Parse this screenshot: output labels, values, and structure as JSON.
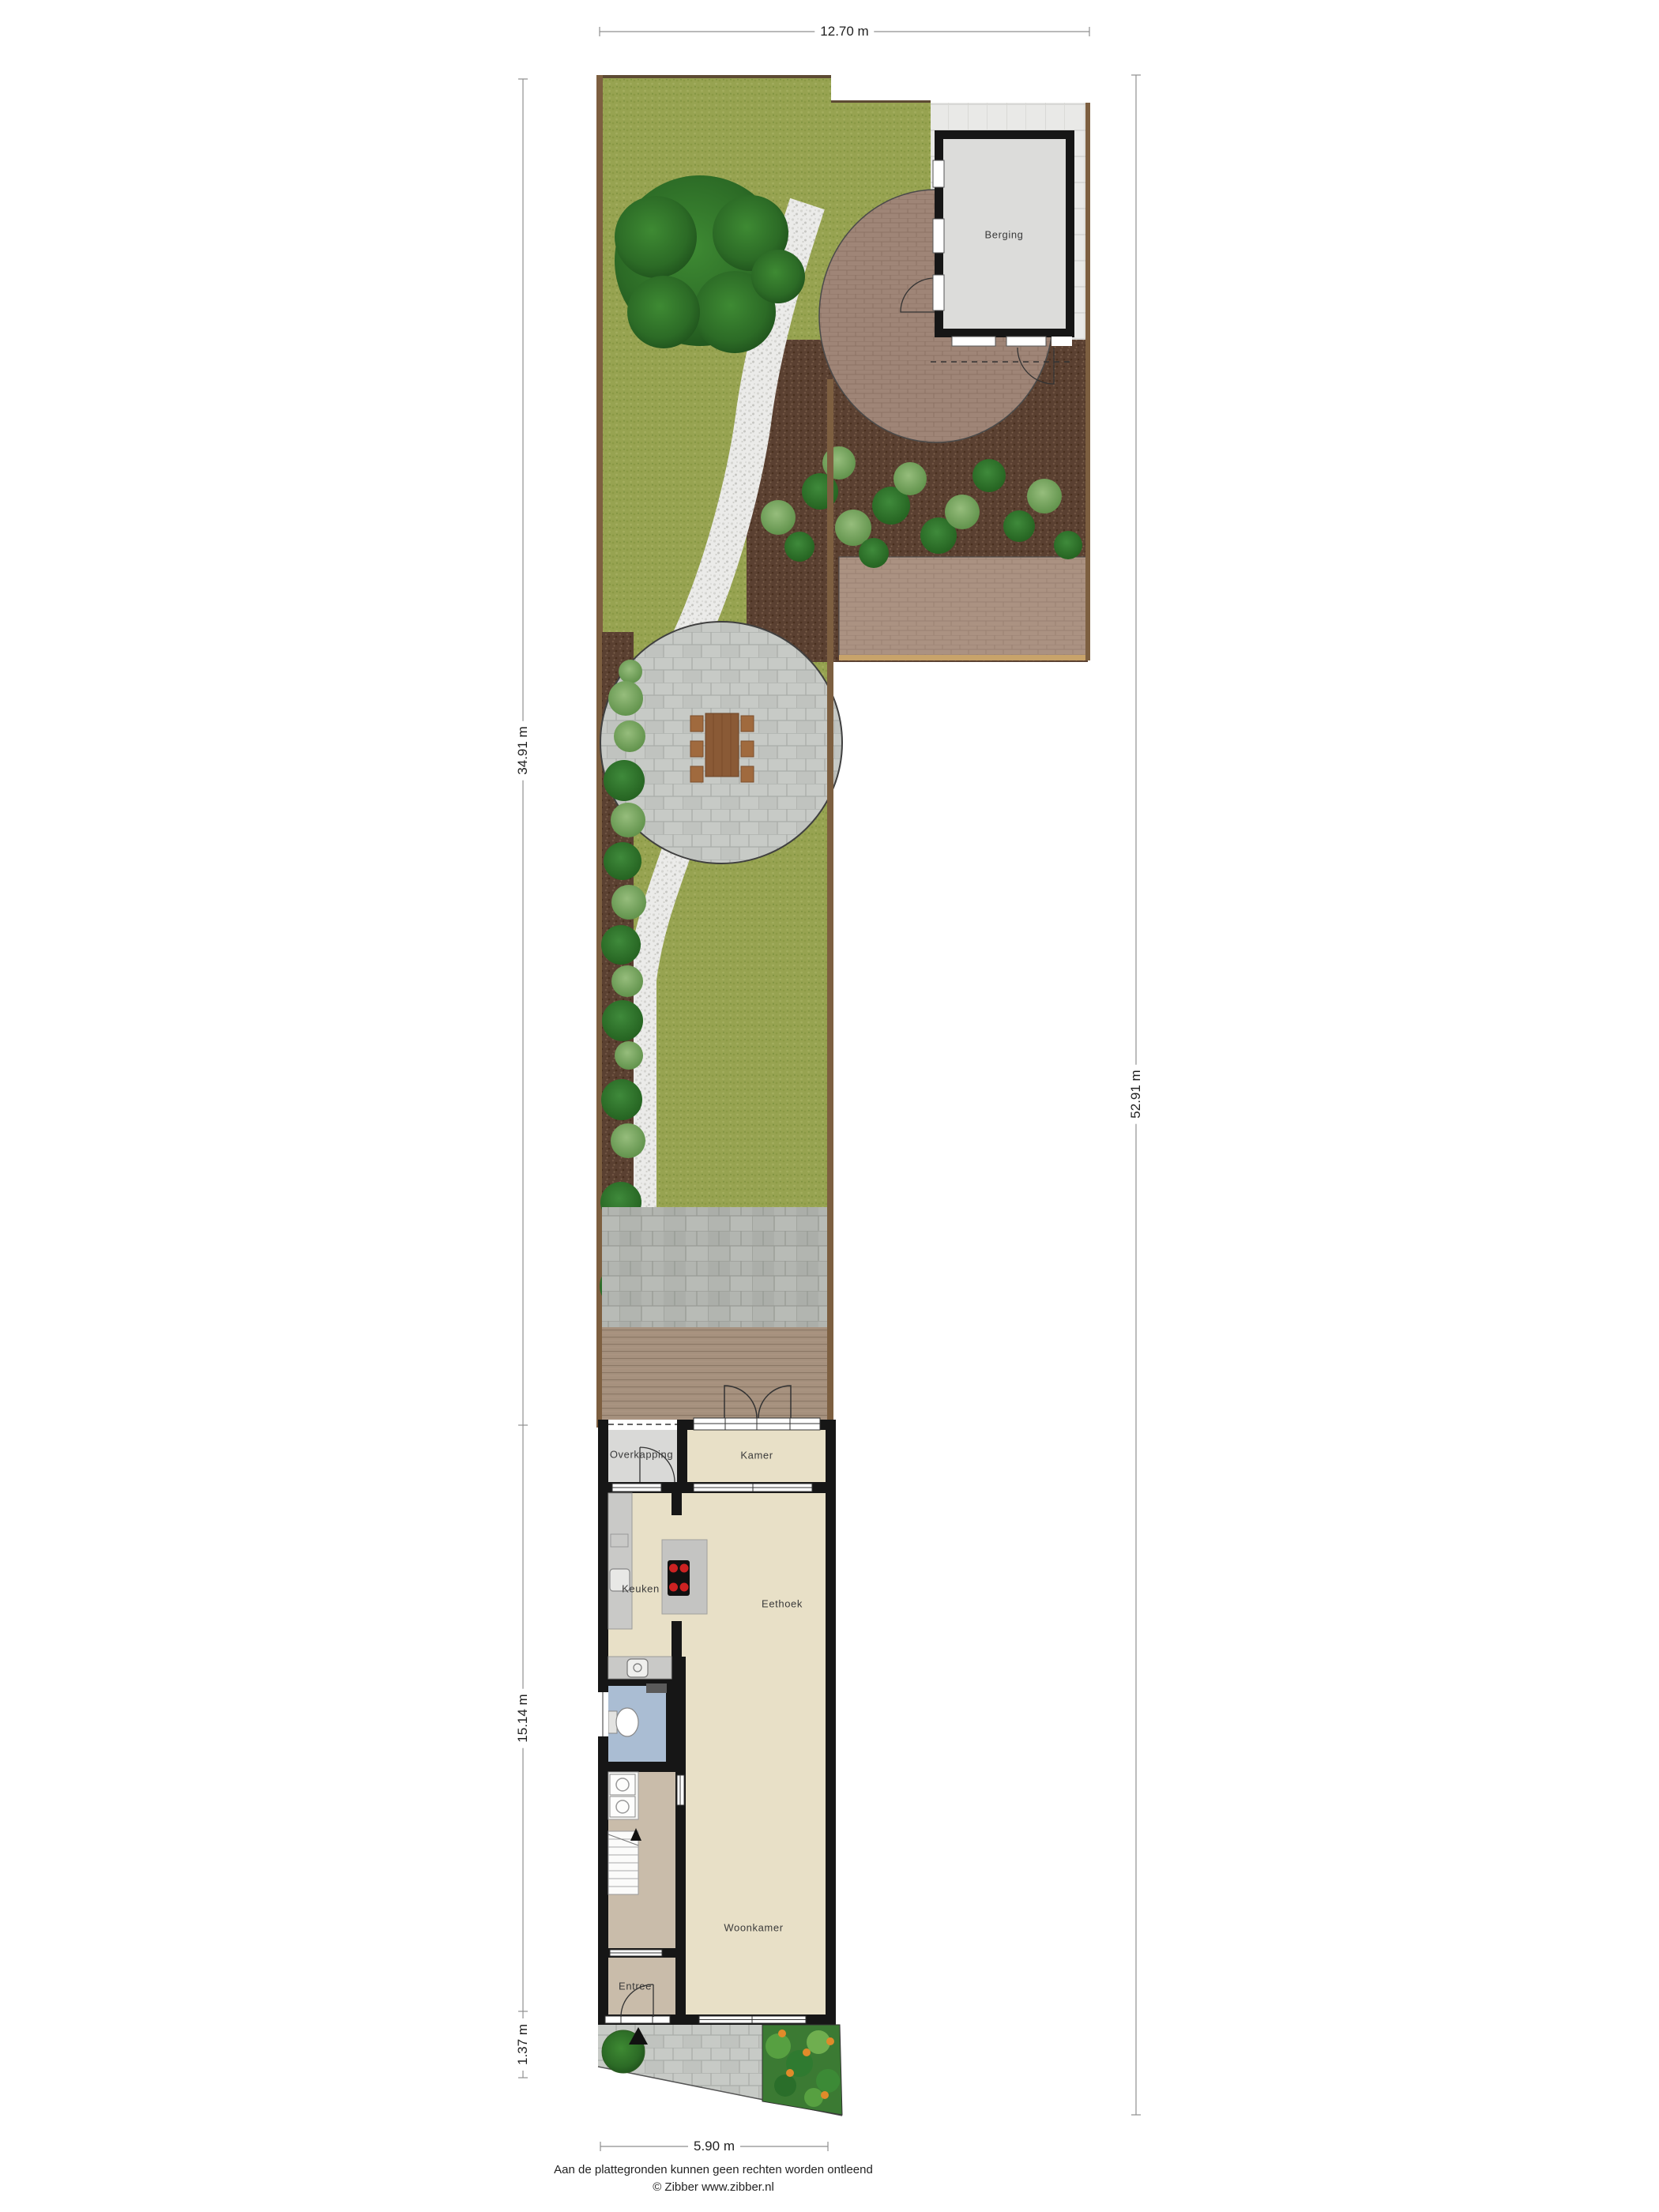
{
  "dimensions": {
    "top": "12.70 m",
    "left_garden": "34.91 m",
    "left_house": "15.14 m",
    "left_front": "1.37 m",
    "right_total": "52.91 m",
    "bottom": "5.90 m"
  },
  "rooms": {
    "berging": "Berging",
    "overkapping": "Overkapping",
    "kamer": "Kamer",
    "keuken": "Keuken",
    "eethoek": "Eethoek",
    "woonkamer": "Woonkamer",
    "entree": "Entree"
  },
  "footer": {
    "disclaimer": "Aan de plattegronden kunnen geen rechten worden ontleend",
    "credit": "© Zibber www.zibber.nl"
  },
  "colors": {
    "lawn": "#97a351",
    "soil": "#5a4031",
    "gravel": "#ebebe9",
    "brick": "#9f8577",
    "brick_path": "#ab9282",
    "stone_paver": "#c7cac6",
    "terrace": "#b2b5b0",
    "deck": "#a6917e",
    "tile": "#e9e9e7",
    "shed_floor": "#dcdcda",
    "wall": "#161616",
    "floor_beige": "#e8e0c7",
    "floor_hall": "#c9bcaa",
    "floor_bath": "#aabdd3",
    "floor_overkapping": "#d9d9d7",
    "fence": "#7d5f40",
    "dim_line": "#8f8f8f",
    "shrub_dark": "#2e7d33",
    "shrub_light": "#7fae66",
    "accent_burner": "#cc2222",
    "accent_flower": "#e08b2a"
  }
}
